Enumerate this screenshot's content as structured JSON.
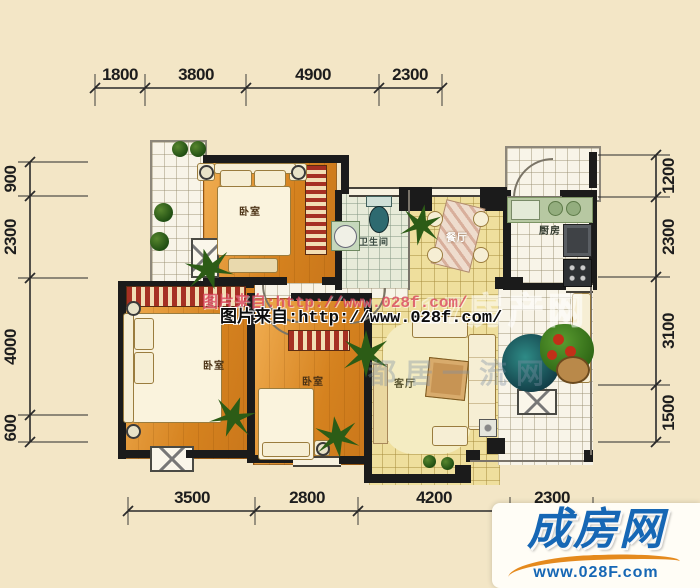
{
  "dimensions": {
    "top": [
      "1800",
      "3800",
      "4900",
      "2300"
    ],
    "bottom": [
      "3500",
      "2800",
      "4200",
      "2300"
    ],
    "left": [
      "900",
      "2300",
      "4000",
      "600"
    ],
    "right": [
      "1200",
      "2300",
      "3100",
      "1500"
    ]
  },
  "rooms": {
    "bedroom_top": "卧室",
    "bedroom_left": "卧室",
    "bedroom_middle": "卧室",
    "bathroom": "卫生间",
    "dining": "餐厅",
    "kitchen": "厨房",
    "living": "客厅"
  },
  "watermarks": {
    "line_red": "图片来自:http://www.028f.com/",
    "line_black": "图片来自:http://www.028f.com/",
    "faint_outline": "17房产网",
    "faint_gray": "都居一流网"
  },
  "logo": {
    "name": "成房网",
    "url": "www.028F.com"
  },
  "colors": {
    "background": "#f3e6c6",
    "wall": "#1b1b1b",
    "wood_floor": "#d5821f",
    "tile_yellow": "#efdf9d",
    "logo_blue": "#1667b5",
    "logo_orange": "#e58a1d",
    "watermark_red": "#da465c"
  }
}
